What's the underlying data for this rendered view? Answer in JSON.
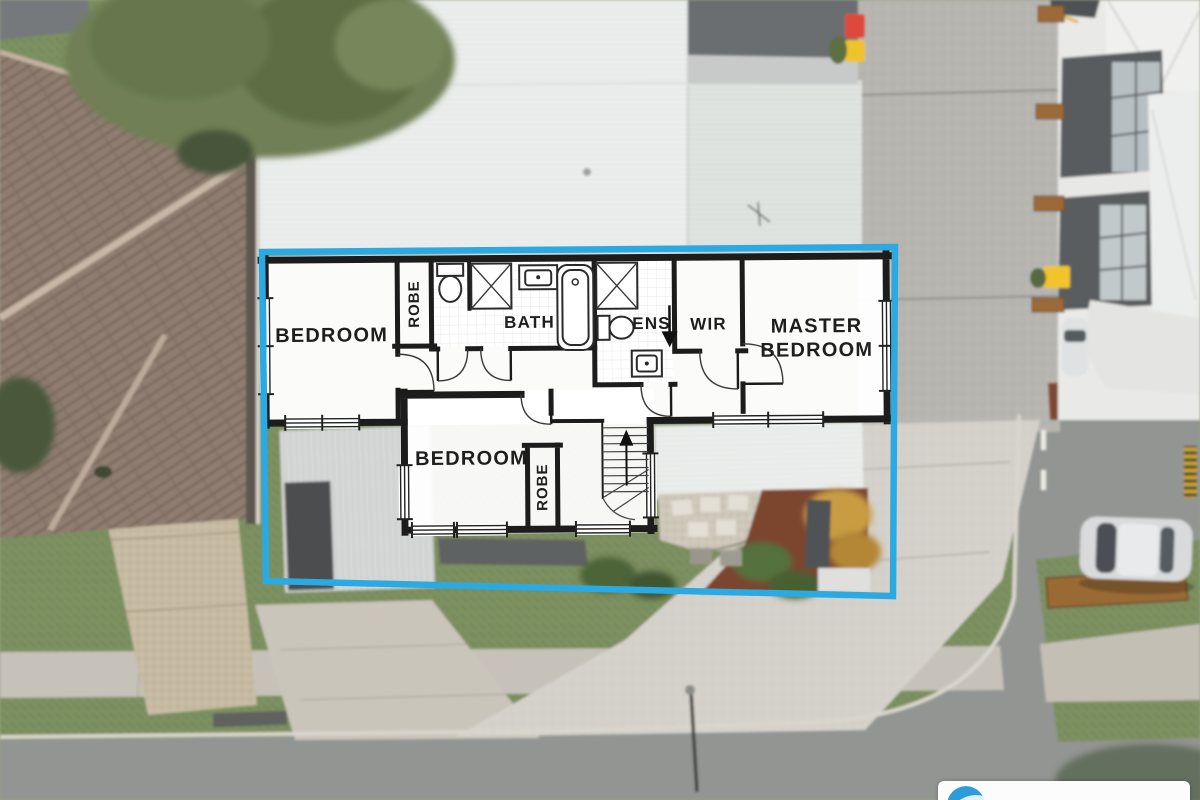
{
  "floorplan": {
    "boundary_color": "#2BA9E2",
    "wall_color": "#1c1c1c",
    "rooms": {
      "bedroom1": "BEDROOM",
      "robe1": "ROBE",
      "bath": "BATH",
      "ens": "ENS",
      "wir": "WIR",
      "master_line1": "MASTER",
      "master_line2": "BEDROOM",
      "bedroom2": "BEDROOM",
      "robe2": "ROBE"
    }
  },
  "branding": {
    "logo_color": "#2D9CDB",
    "logo_bg": "#ffffff"
  }
}
